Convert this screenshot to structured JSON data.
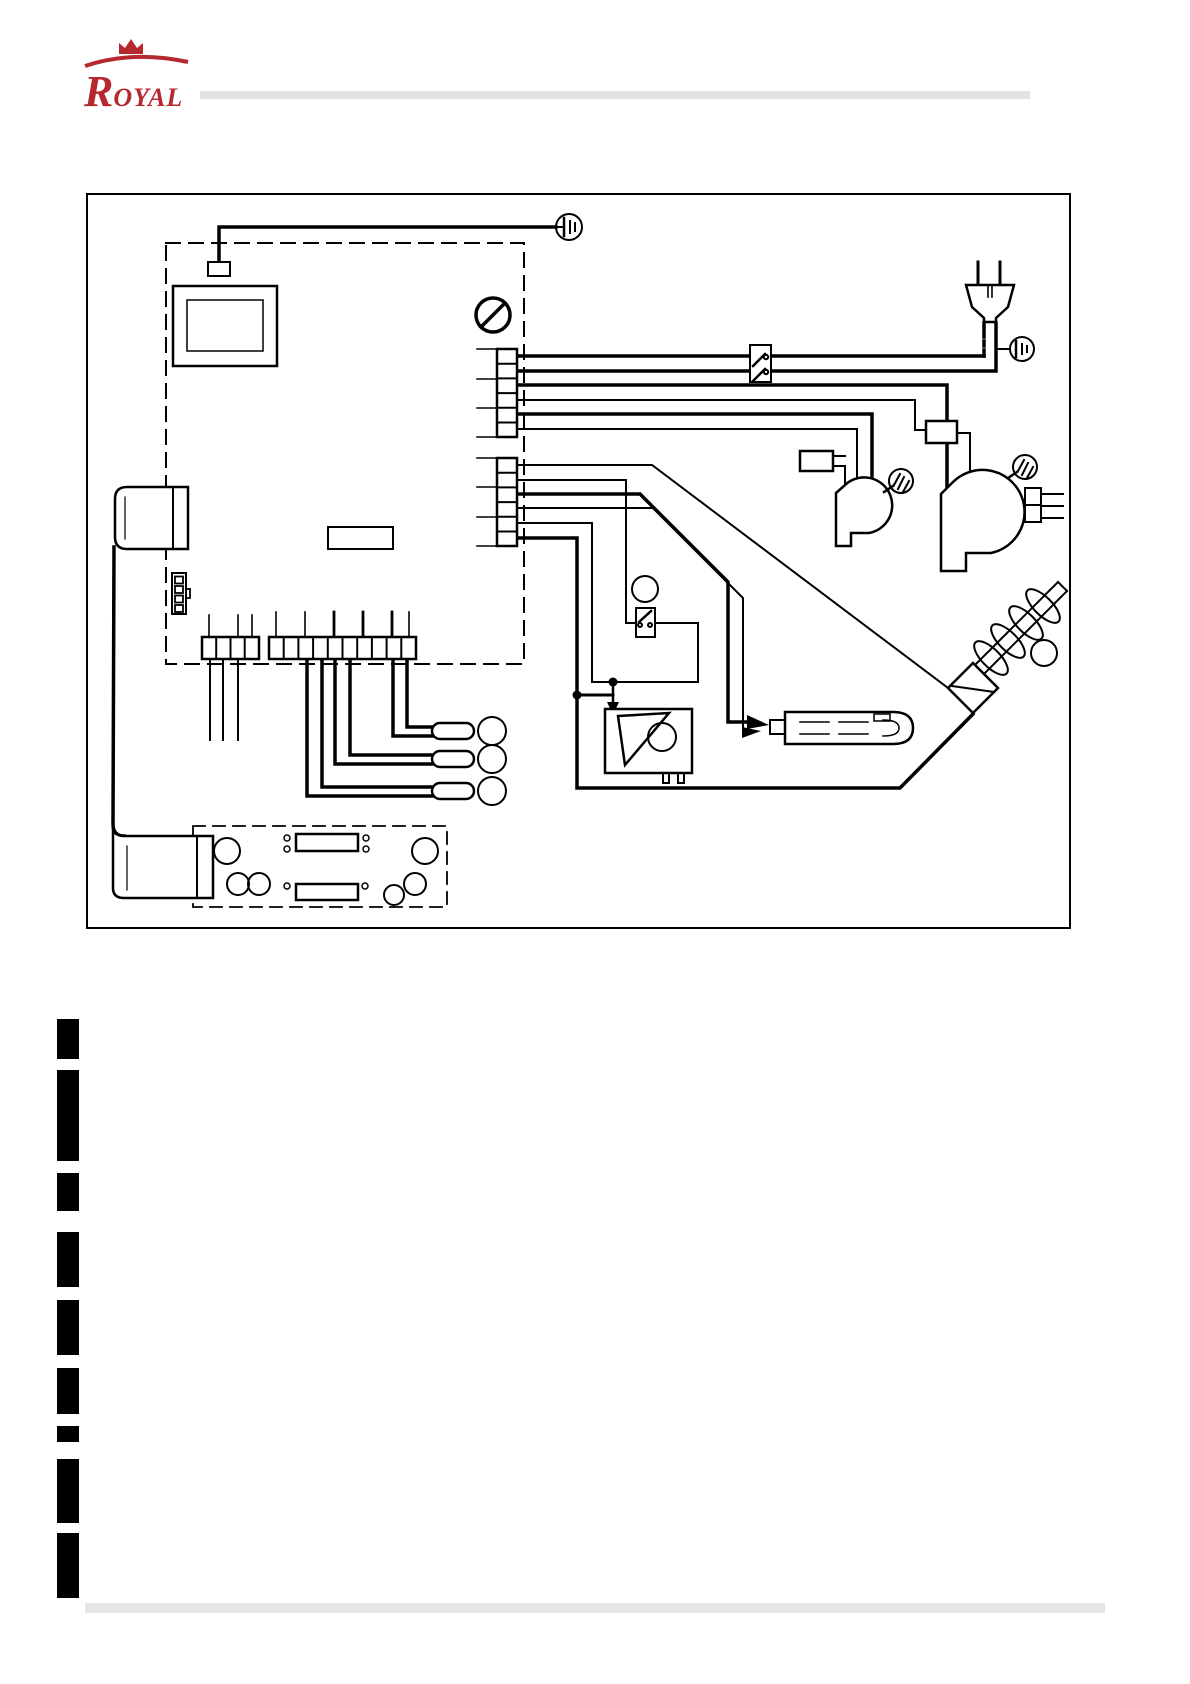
{
  "logo": {
    "initial": "R",
    "rest": "OYAL"
  },
  "theme": {
    "brand_red": "#b5282e",
    "rule_gray": "#e3e3e3",
    "line_black": "#000000",
    "paper_white": "#ffffff"
  },
  "diagram": {
    "symbols": [
      "control-board-dashed-outline",
      "display-unit",
      "earth-ground-icon",
      "prohibition-icon",
      "mains-plug-icon",
      "fuse-switch",
      "terminal-strip-upper",
      "terminal-strip-lower",
      "capacitor",
      "exhaust-blower-motor",
      "room-blower-motor",
      "screw-fastener-icon",
      "pressure-switch",
      "auger-gear-motor",
      "igniter-element",
      "auger-screw",
      "sensor-lug",
      "reference-bubble",
      "ribbon-cable-connector",
      "display-board-dashed-outline",
      "push-button",
      "seven-segment-display",
      "led-indicator"
    ],
    "reference_bubbles_text": [
      "",
      "",
      "",
      "",
      "",
      ""
    ]
  },
  "redactions": {
    "bar_count": 9
  }
}
